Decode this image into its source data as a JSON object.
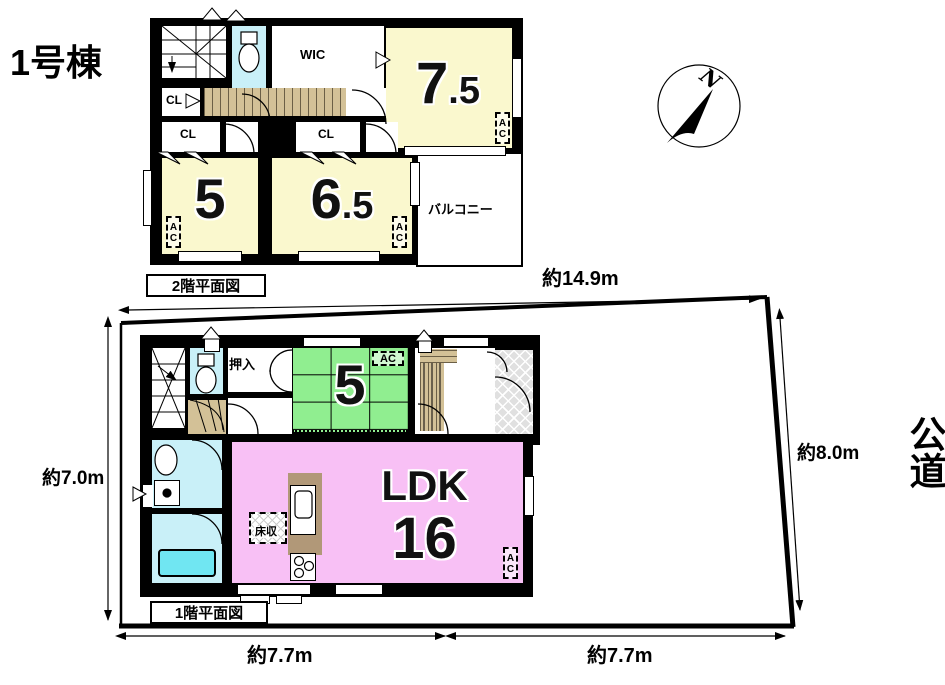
{
  "title": "1号棟",
  "compass": {
    "north": "N"
  },
  "road": {
    "label": "公道"
  },
  "dimensions": {
    "top": "約14.9m",
    "right": "約8.0m",
    "left": "約7.0m",
    "bottom_left": "約7.7m",
    "bottom_right": "約7.7m"
  },
  "colors": {
    "room_yellow": "#faf8ce",
    "room_green": "#90ee90",
    "room_pink": "#f8c0f5",
    "water_cyan": "#c9f0f8",
    "stair_tan": "#d3c197"
  },
  "floor2": {
    "caption": "2階平面図",
    "wic": "WIC",
    "cl1": "CL",
    "cl2": "CL",
    "cl3": "CL",
    "room_7_5": {
      "size_int": "7",
      "size_dec": ".5",
      "ac": "AC"
    },
    "room_5": {
      "size": "5",
      "ac": "AC"
    },
    "room_6_5": {
      "size_int": "6",
      "size_dec": ".5",
      "ac": "AC"
    },
    "balcony": "バルコニー"
  },
  "floor1": {
    "caption": "1階平面図",
    "closet": "押入",
    "tatami_room": {
      "size": "5",
      "ac": "AC"
    },
    "ldk": {
      "label": "LDK",
      "size": "16",
      "ac": "AC"
    },
    "floor_storage": "床収"
  }
}
